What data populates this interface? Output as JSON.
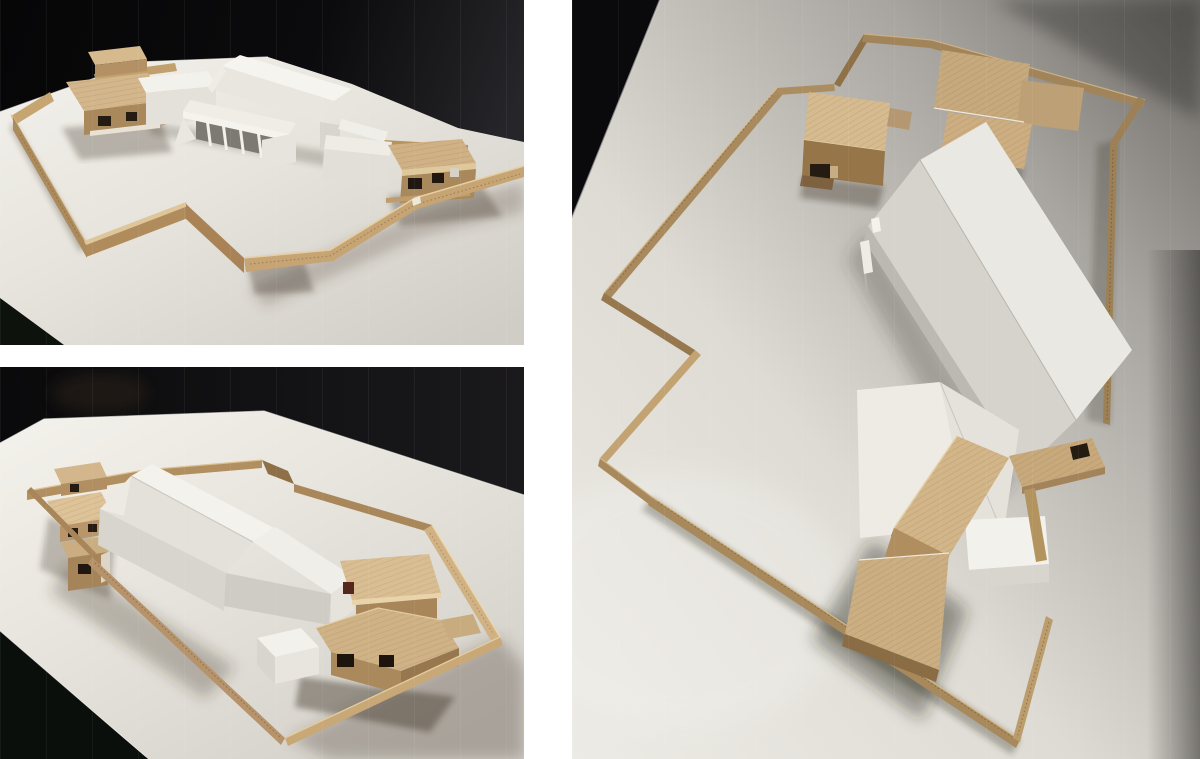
{
  "page": {
    "background": "#ffffff",
    "title": "Architectural massing model — photo collage"
  },
  "collage": {
    "panels": [
      {
        "id": "top-left",
        "label": "Photograph of architectural site model, eye-level view from the front",
        "position": "top-left"
      },
      {
        "id": "bottom-left",
        "label": "Photograph of architectural site model, raised oblique view",
        "position": "bottom-left"
      },
      {
        "id": "right",
        "label": "Photograph of architectural site model, aerial oblique view",
        "position": "right"
      }
    ],
    "scene": {
      "materials": [
        "white card buildings",
        "balsa wood blocks",
        "corrugated cardboard boundary wall",
        "white site board"
      ],
      "background": "black studio backdrop"
    },
    "palette": {
      "backdrop": "#0a0a0c",
      "board_bright": "#f2f0ea",
      "board_mid": "#ddd9d2",
      "board_dim": "#b3afa9",
      "cardboard_top": "#dcc094",
      "cardboard_face": "#ab8a5c",
      "cardboard_dark": "#7c5f3b",
      "balsa_top": "#d3b68b",
      "balsa_front": "#a9885c",
      "balsa_dark": "#6f5536",
      "card_white": "#f3f1eb",
      "card_grey": "#d8d5ce",
      "card_shade": "#bcb9b2"
    }
  }
}
